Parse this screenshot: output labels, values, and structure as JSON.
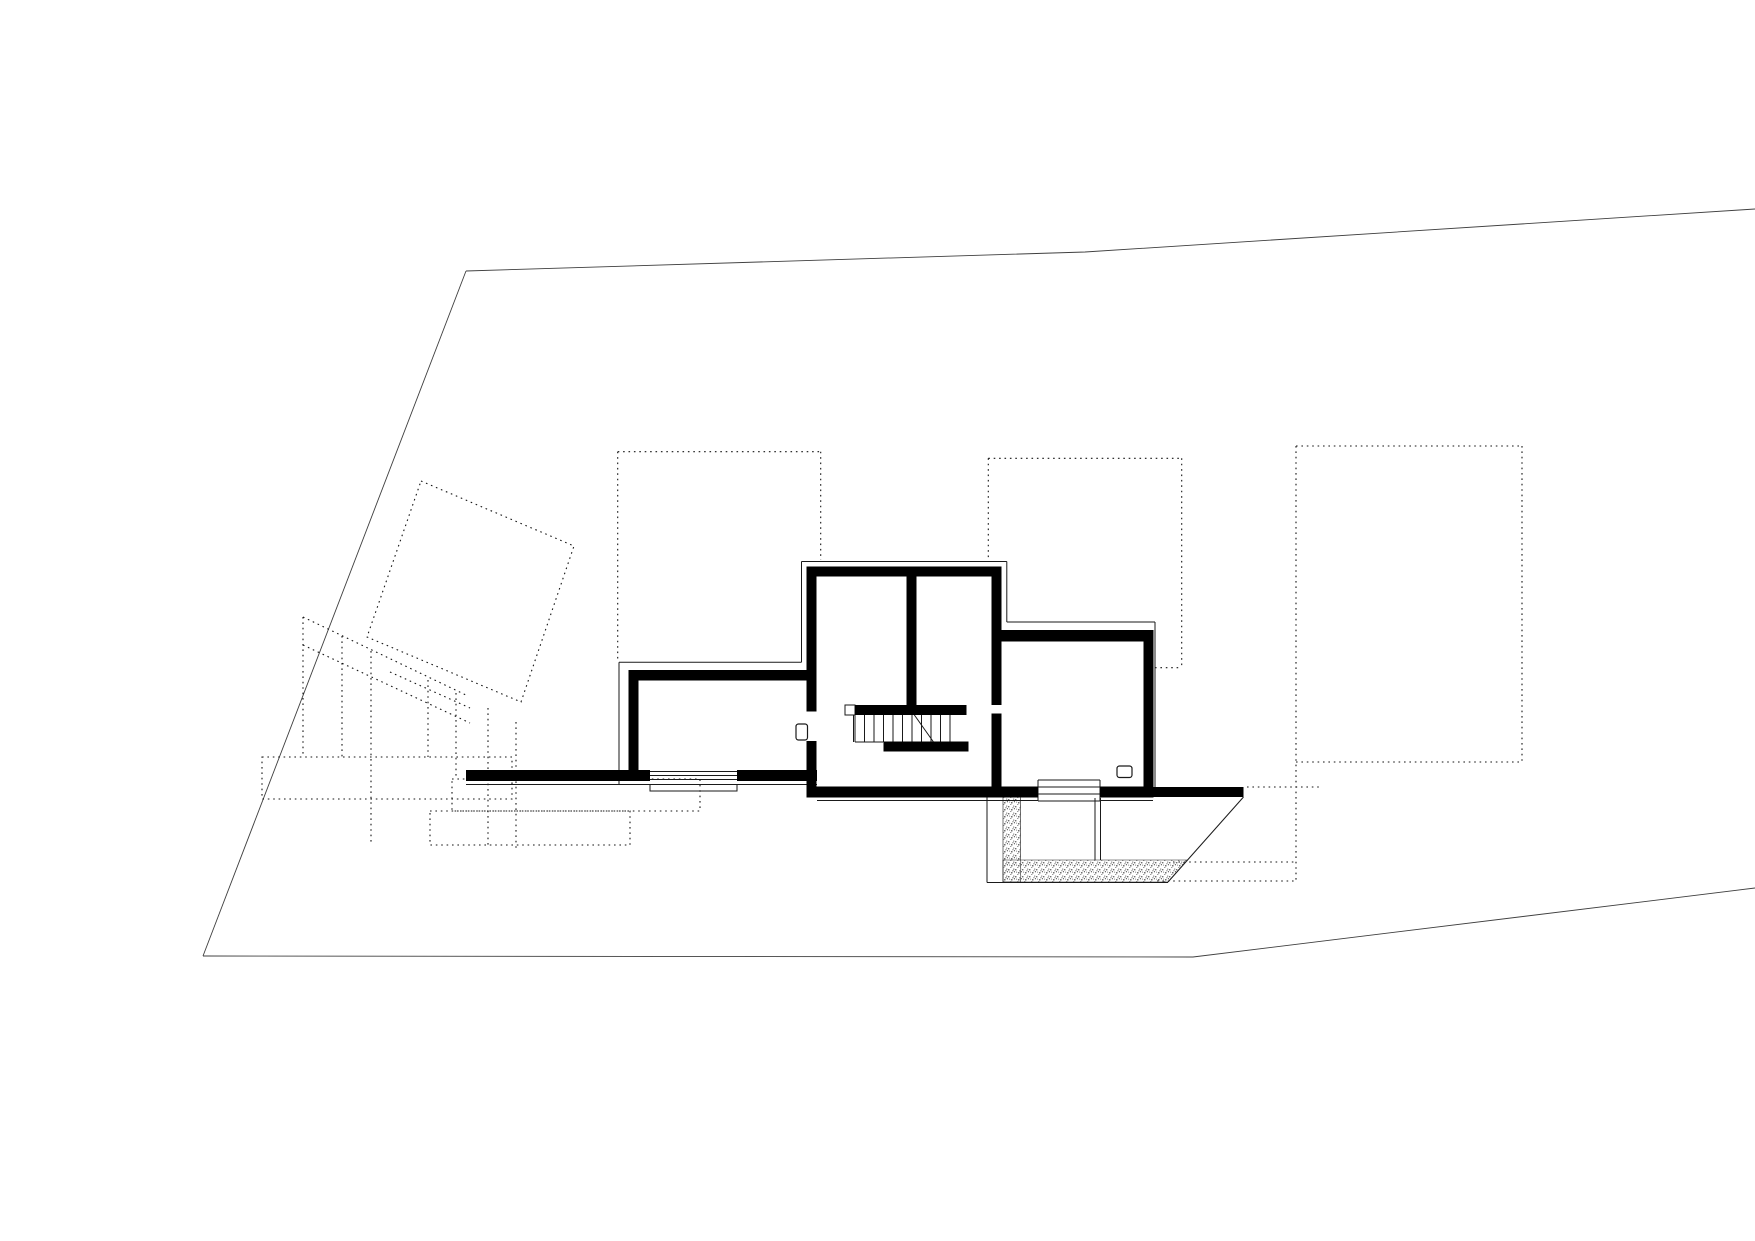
{
  "canvas": {
    "width": 1755,
    "height": 1241,
    "background": "#ffffff"
  },
  "colors": {
    "wall": "#000000",
    "thin_line": "#1a1a1a",
    "site_boundary": "#3f3f3f",
    "dotted_line": "#161616",
    "door_fill": "#ffffff",
    "stipple_dot_dark": "#6f6f6f",
    "stipple_dot_light": "#9a9a9a"
  },
  "drawing": {
    "site_boundary": {
      "polylines": [
        [
          [
            466,
            271
          ],
          [
            1085,
            252
          ],
          [
            1755,
            209
          ]
        ],
        [
          [
            466,
            271
          ],
          [
            203,
            956
          ]
        ],
        [
          [
            203,
            956
          ],
          [
            1193,
            957
          ],
          [
            1755,
            888
          ]
        ]
      ]
    },
    "dotted": {
      "segments": [
        [
          617.7,
          451.7,
          820.7,
          451.7
        ],
        [
          617.7,
          451.7,
          617.7,
          660
        ],
        [
          820.7,
          451.7,
          820.7,
          560
        ],
        [
          988.3,
          458.3,
          1181.7,
          458.3
        ],
        [
          988.3,
          458.3,
          988.3,
          560
        ],
        [
          1181.7,
          458.3,
          1181.7,
          667.7
        ],
        [
          1155,
          667.7,
          1181.7,
          667.7
        ],
        [
          1296,
          446,
          1522,
          446
        ],
        [
          1296,
          446,
          1296,
          881
        ],
        [
          1522,
          446,
          1522,
          762
        ],
        [
          1296,
          762,
          1522,
          762
        ],
        [
          1247,
          787,
          1320,
          787
        ],
        [
          1173,
          862,
          1296,
          862
        ],
        [
          1157,
          881,
          1296,
          881
        ],
        [
          303,
          617,
          468,
          696
        ],
        [
          303,
          645,
          470,
          723
        ],
        [
          390,
          672,
          470,
          708
        ],
        [
          303,
          617,
          303,
          757
        ],
        [
          342,
          636,
          342,
          757
        ],
        [
          371,
          651,
          371,
          845
        ],
        [
          428,
          680,
          428,
          757
        ],
        [
          456,
          693,
          456,
          778
        ],
        [
          488,
          708,
          488,
          848
        ],
        [
          516,
          722,
          516,
          848
        ]
      ],
      "polygons": [
        [
          [
            421,
            481
          ],
          [
            574,
            546
          ],
          [
            521,
            702
          ],
          [
            367,
            637
          ]
        ]
      ],
      "rects": [
        [
          262,
          757,
          250,
          42
        ],
        [
          452,
          779,
          248,
          32
        ],
        [
          430,
          811,
          200,
          34
        ]
      ]
    },
    "walls": {
      "rects": [
        [
          806.7,
          566.7,
          195,
          10
        ],
        [
          806.7,
          566.7,
          10,
          145
        ],
        [
          806.7,
          741,
          10,
          56.3
        ],
        [
          906.7,
          576.7,
          10,
          138.3
        ],
        [
          991.7,
          566.7,
          10,
          138.3
        ],
        [
          991.7,
          713.3,
          10,
          73.4
        ],
        [
          628.3,
          670,
          178.4,
          10.7
        ],
        [
          628.3,
          670,
          10,
          111
        ],
        [
          466,
          770,
          184,
          11
        ],
        [
          737,
          770,
          80,
          11
        ],
        [
          806.7,
          786.7,
          231.3,
          10.6
        ],
        [
          1100,
          786.7,
          53.3,
          10.6
        ],
        [
          1153.3,
          787,
          90.2,
          10
        ],
        [
          1001.7,
          630,
          141.6,
          11.7
        ],
        [
          1143.3,
          630,
          10,
          167.3
        ],
        [
          855,
          705,
          111.7,
          10
        ],
        [
          883.3,
          741.7,
          85,
          10
        ]
      ]
    },
    "thin": {
      "segments": [
        [
          801.5,
          561.5,
          1006.8,
          561.5
        ],
        [
          801.5,
          561.5,
          801.5,
          662.3
        ],
        [
          619,
          662.3,
          801.5,
          662.3
        ],
        [
          619,
          662.3,
          619,
          784.5
        ],
        [
          466,
          784.5,
          817,
          784.5
        ],
        [
          1006.8,
          561.5,
          1006.8,
          622
        ],
        [
          1006.8,
          622,
          1155,
          622
        ],
        [
          1155,
          622,
          1155,
          787
        ],
        [
          817,
          800.5,
          1038,
          800.5
        ],
        [
          1100,
          800.5,
          1153,
          800.5
        ],
        [
          987,
          797,
          987,
          882.5
        ],
        [
          987,
          882.5,
          1168,
          882.5
        ],
        [
          1095,
          798,
          1095,
          860
        ],
        [
          1100.5,
          798,
          1100.5,
          860
        ],
        [
          1243.5,
          797,
          1168,
          882
        ],
        [
          853.5,
          715,
          853.5,
          742
        ],
        [
          855,
          742,
          883.3,
          742
        ],
        [
          650,
          771.5,
          737,
          771.5
        ],
        [
          650,
          775.5,
          737,
          775.5
        ],
        [
          650,
          779.5,
          737,
          779.5
        ],
        [
          1038,
          780,
          1100,
          780
        ],
        [
          1038,
          787,
          1100,
          787
        ],
        [
          1038,
          794,
          1100,
          794
        ],
        [
          1038,
          801,
          1100,
          801
        ],
        [
          1038,
          780,
          1038,
          801
        ],
        [
          1100,
          780,
          1100,
          801
        ]
      ],
      "rects": [
        [
          845,
          705,
          10,
          10
        ],
        [
          650,
          784.5,
          87,
          6.5
        ]
      ]
    },
    "stair": {
      "treads_x": [
        855,
        864.5,
        874,
        883.5,
        893,
        902.5,
        912,
        921.5,
        931,
        940.5,
        950
      ],
      "tread_y1": 715,
      "tread_y2": 742,
      "diagonal": [
        908,
        706,
        933.5,
        742
      ]
    },
    "doors": [
      [
        796,
        724,
        11.5,
        16
      ],
      [
        1117,
        766,
        15,
        11.5
      ]
    ],
    "stipple": {
      "polygons": [
        [
          [
            1003,
            797
          ],
          [
            1020.5,
            797
          ],
          [
            1020.5,
            882
          ],
          [
            1003,
            882
          ]
        ],
        [
          [
            1003,
            860
          ],
          [
            1187.6,
            860
          ],
          [
            1168,
            882
          ],
          [
            1003,
            882
          ]
        ]
      ]
    }
  }
}
